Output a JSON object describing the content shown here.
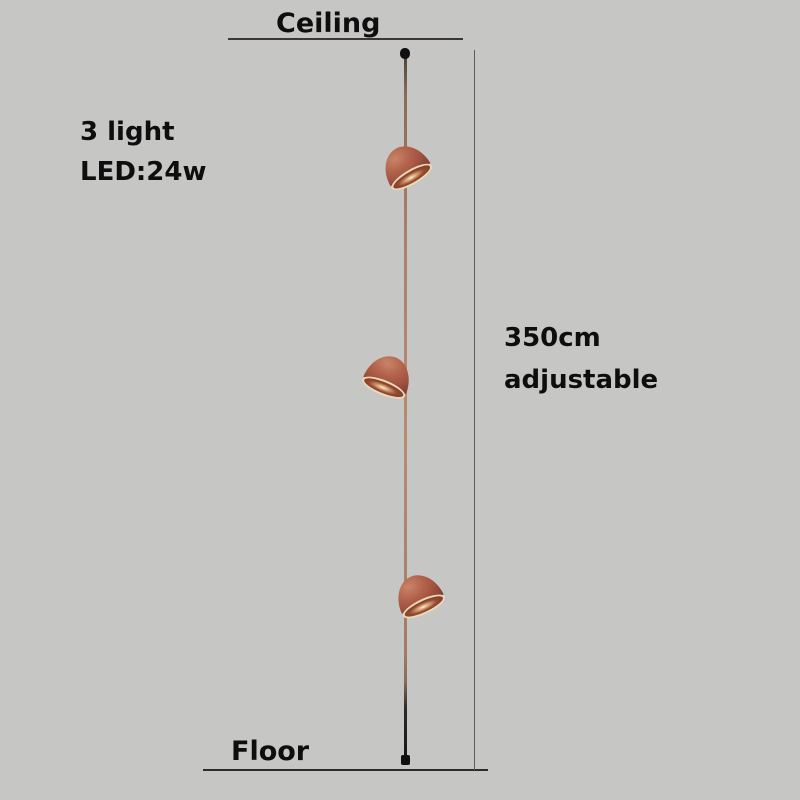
{
  "page": {
    "background_color": "#c6c6c4",
    "text_color": "#0e0e0e"
  },
  "annotations": {
    "ceiling_label": "Ceiling",
    "floor_label": "Floor",
    "spec_line1": "3 light",
    "spec_line2": "LED:24w",
    "dimension_line1": "350cm",
    "dimension_line2": "adjustable"
  },
  "product": {
    "type": "pendant-lamp-diagram",
    "light_count": 3,
    "colors": {
      "shade": "#ab5847",
      "shade_highlight": "#c8846a",
      "shade_shadow": "#7c3b2d",
      "rim": "#ead9b9",
      "cable_copper": "#b58c72",
      "line_color": "#3e3630"
    }
  }
}
